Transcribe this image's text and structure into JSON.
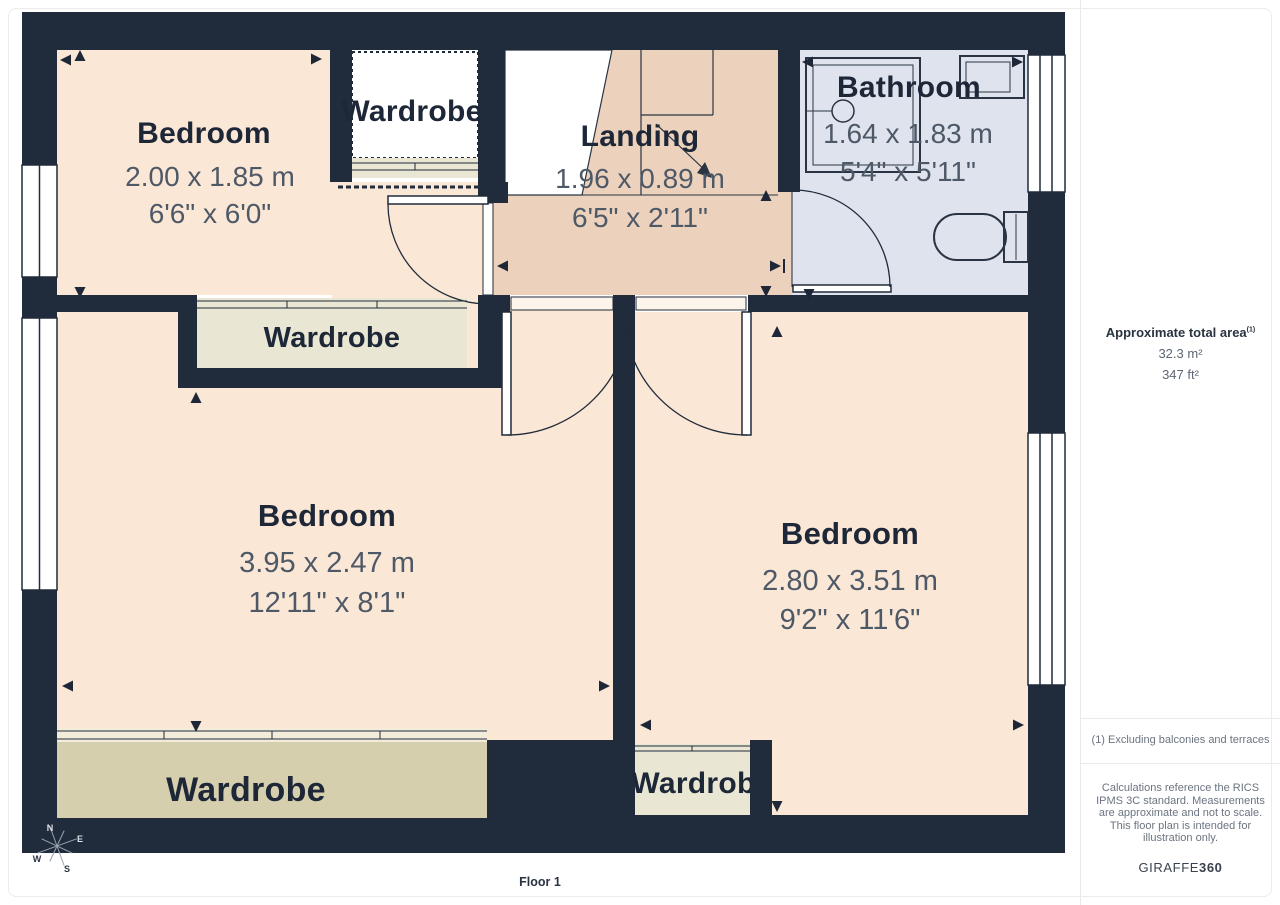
{
  "plan": {
    "floor_label": "Floor 1",
    "rooms": {
      "bedroom_top_left": {
        "name": "Bedroom",
        "metric": "2.00 x 1.85 m",
        "imperial": "6'6\" x 6'0\""
      },
      "landing": {
        "name": "Landing",
        "metric": "1.96 x 0.89 m",
        "imperial": "6'5\" x 2'11\""
      },
      "bathroom": {
        "name": "Bathroom",
        "metric": "1.64 x 1.83 m",
        "imperial": "5'4\" x 5'11\""
      },
      "bedroom_center": {
        "name": "Bedroom",
        "metric": "3.95 x 2.47 m",
        "imperial": "12'11\" x 8'1\""
      },
      "bedroom_right": {
        "name": "Bedroom",
        "metric": "2.80 x 3.51 m",
        "imperial": "9'2\" x 11'6\""
      },
      "wardrobe_top": {
        "name": "Wardrobe"
      },
      "wardrobe_middle": {
        "name": "Wardrobe"
      },
      "wardrobe_bottom_left": {
        "name": "Wardrobe"
      },
      "wardrobe_bottom_middle": {
        "name": "Wardrobe"
      }
    },
    "compass": {
      "n": "N",
      "e": "E",
      "w": "W",
      "s": "S"
    }
  },
  "sidebar": {
    "area_title": "Approximate total area",
    "area_title_superscript": "(1)",
    "area_metric": "32.3 m²",
    "area_imperial": "347 ft²",
    "footnote": "(1) Excluding balconies and terraces",
    "disclaimer": "Calculations reference the RICS IPMS 3C standard. Measurements are approximate and not to scale. This floor plan is intended for illustration only.",
    "brand_prefix": "GIRAFFE",
    "brand_suffix": "360"
  },
  "colors": {
    "wall": "#202b3b",
    "bedroom_floor": "#fbe7d5",
    "landing_floor": "#ecd2bc",
    "bathroom_floor": "#dee3ee",
    "wardrobe_light": "#e9e6d3",
    "wardrobe_dark": "#d6cfae",
    "title_text": "#1d2737",
    "dimension_text": "#4e5968"
  }
}
